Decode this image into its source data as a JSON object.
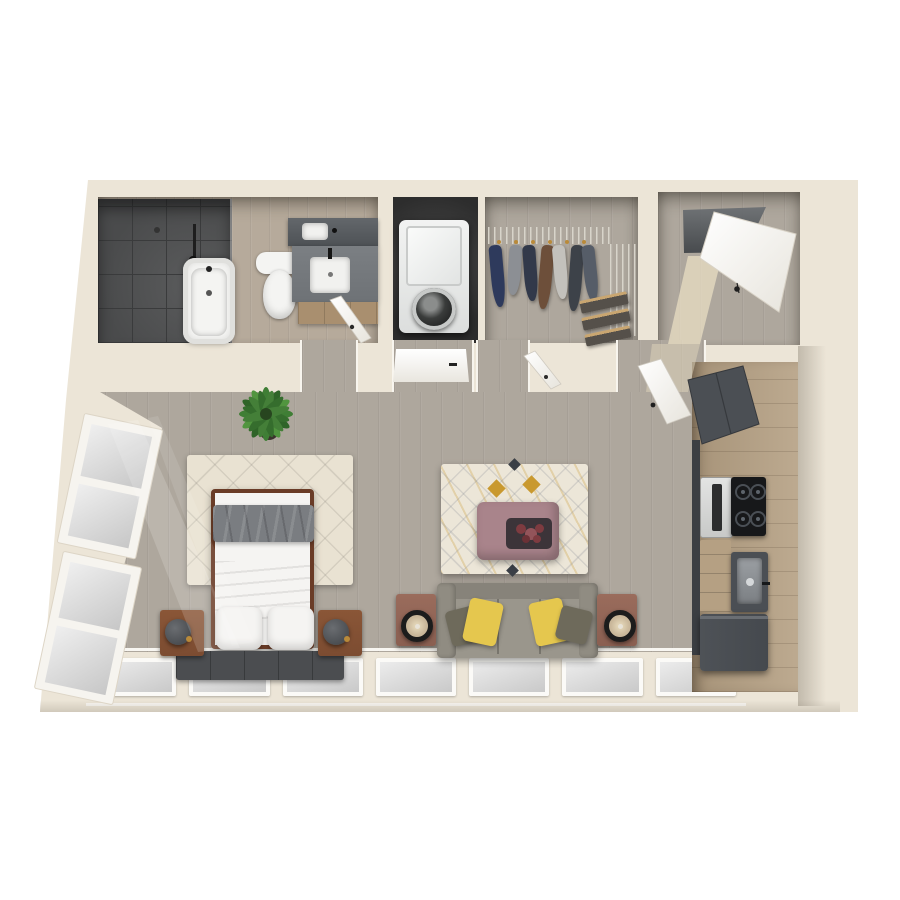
{
  "canvas": {
    "width": 900,
    "height": 900
  },
  "scene": {
    "type": "3d-floor-plan-top-view",
    "unit": "studio apartment",
    "rooms": [
      {
        "name": "bathroom",
        "fixtures": [
          "walk-in-shower",
          "bathtub",
          "toilet",
          "vanity-with-sink",
          "mirror"
        ]
      },
      {
        "name": "laundry-closet",
        "fixtures": [
          "stacked-washer-dryer"
        ]
      },
      {
        "name": "walk-in-closet",
        "fixtures": [
          "wire-shelving",
          "hanging-clothes",
          "folded-clothes-shelves"
        ]
      },
      {
        "name": "entry",
        "fixtures": [
          "open-front-door"
        ]
      },
      {
        "name": "living-sleeping-area",
        "fixtures": [
          "bed",
          "shag-rug",
          "nightstands",
          "table-lamps",
          "bench-runner",
          "patterned-rug",
          "ottoman",
          "flower-tray",
          "sofa",
          "throw-pillows",
          "side-tables",
          "potted-plant",
          "angled-window-wall",
          "window-band"
        ]
      },
      {
        "name": "kitchenette",
        "fixtures": [
          "upper-cabinet",
          "microwave",
          "cooktop",
          "drawer-stack",
          "sink-unit",
          "refrigerator",
          "oak-cabinet-run"
        ]
      }
    ],
    "garment_colors": [
      "cloth-1",
      "cloth-2",
      "cloth-3",
      "cloth-4",
      "cloth-5",
      "cloth-6",
      "cloth-7"
    ],
    "bottom_window_pane_count": 7,
    "cooktop_burner_count": 4
  },
  "palette": {
    "wall": "#ece5d7",
    "wall-hi": "#f4eee2",
    "wall-sh": "#d8d0c0",
    "wall-dk": "#c4bcab",
    "floor": "#aea79d",
    "floor-light": "#b6aa9b",
    "shower": "#4a4b4c",
    "shower-line": "#3a3b3c",
    "fixture": "#f4f4f2",
    "mirror": "#5a5e62",
    "vanity": "#75797d",
    "vanity-wood": "#a98f6f",
    "laundry-dk": "#2d2d2d",
    "washer": "#eceeed",
    "wire": "#d8d4ca",
    "shelf-wood": "#c9a671",
    "door-white": "#f7f5f0",
    "shag": "#e9e2d2",
    "rug": "#ece6d8",
    "rug-gold": "#c9992f",
    "rug-gray": "#8b9097",
    "rug-dk": "#3a3f46",
    "bed-frame": "#6a3c27",
    "bed-white": "#f5f4f2",
    "throw": "#7a7d81",
    "bench": "#4b4d50",
    "nightstand": "#7c4c31",
    "lamp": "#4b4e52",
    "brass": "#b98a3a",
    "sofa": "#9a968c",
    "sofa-dk": "#87837a",
    "pillow-y": "#e5c74e",
    "pillow-o": "#6e6a5b",
    "ottoman": "#a9848b",
    "tray": "#3c3439",
    "flower": "#7e3b40",
    "side-table": "#8a5f51",
    "ring": "#1c1c1c",
    "fan": "#c9b79a",
    "cab-wood": "#b5a083",
    "cab-dark": "#4b4f54",
    "cooktop": "#17181a",
    "steel": "#9ea2a6",
    "fridge": "#45494e",
    "glass": "#dedede",
    "frame": "#f8f6f1",
    "plant": "#3f7e35",
    "plant-dk": "#2f6428",
    "plant-hi": "#51953f",
    "cloth-1": "#2e3a5c",
    "cloth-2": "#8c8f94",
    "cloth-3": "#32394a",
    "cloth-4": "#6d4f3a",
    "cloth-5": "#c3c1bc",
    "cloth-6": "#3d4249",
    "cloth-7": "#565d68"
  }
}
